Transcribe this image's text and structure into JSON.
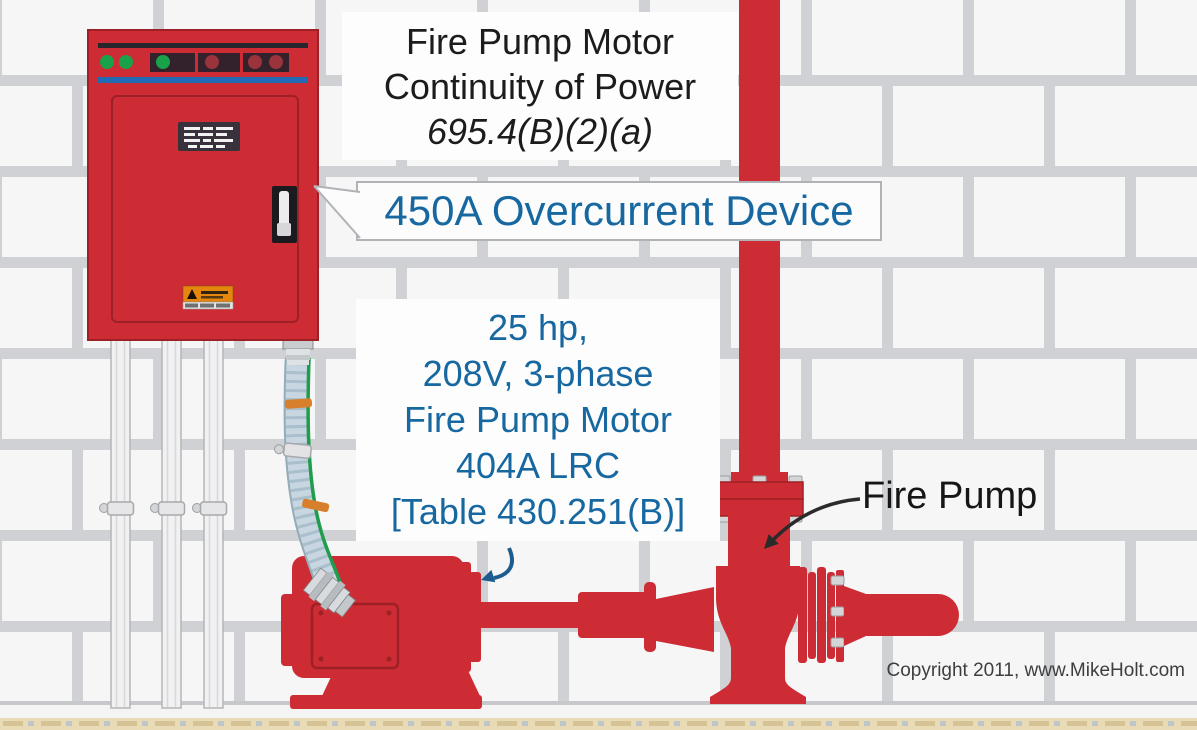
{
  "title": {
    "line1": "Fire Pump Motor",
    "line2": "Continuity of Power",
    "line3": "695.4(B)(2)(a)"
  },
  "callout": {
    "label": "450A Overcurrent Device"
  },
  "motor_spec": {
    "line1": "25 hp,",
    "line2": "208V, 3-phase",
    "line3": "Fire Pump Motor",
    "line4": "404A LRC",
    "line5": "[Table 430.251(B)]"
  },
  "pump_label": {
    "label": "Fire Pump"
  },
  "footer": {
    "copyright": "Copyright 2011, www.MikeHolt.com"
  },
  "colors": {
    "red": "#cd2c34",
    "red_dark": "#9e2027",
    "text_blue": "#1768a0",
    "title_black": "#1c1c1c",
    "arrow_blue": "#1c5c8f",
    "arrow_black": "#2b2b2b",
    "green_light": "#19a24a",
    "indicator_red": "#9a333c",
    "stripe_blue": "#1f6cb4",
    "brick": "#f6f6f7",
    "mortar": "#cfd1d5",
    "flex_conduit_blue": "#c7d6e0",
    "ground_wire_green": "#1f9d4d",
    "warning_orange": "#e5860f",
    "floor_tan": "#eadcb8",
    "copyright_gray": "#3e3e3e"
  }
}
